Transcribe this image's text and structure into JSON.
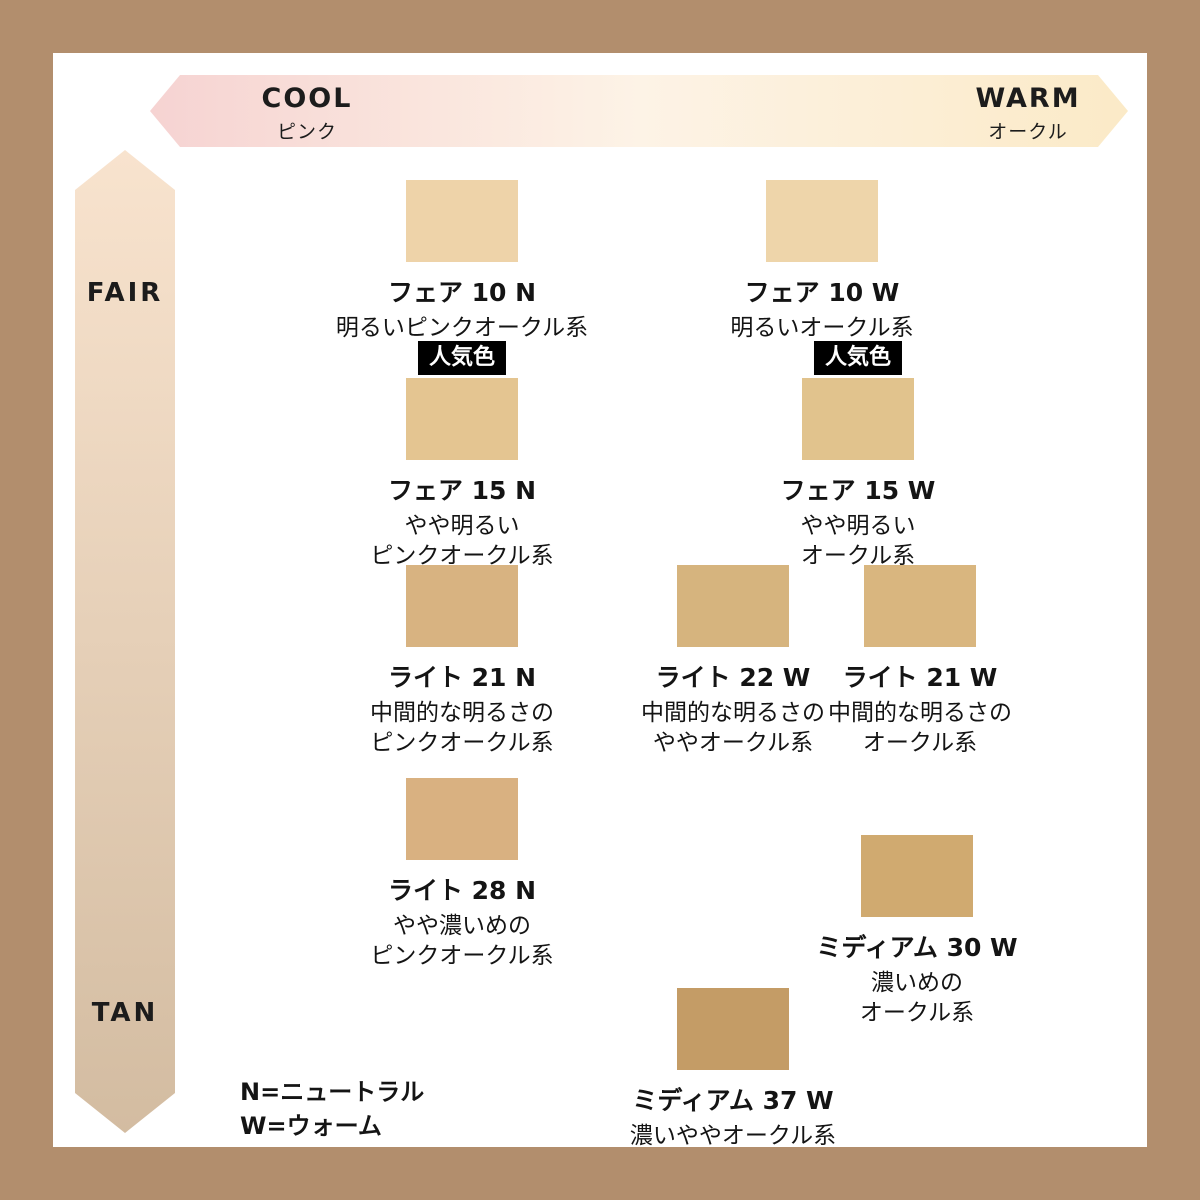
{
  "frame_color": "#b28e6d",
  "axes": {
    "horizontal": {
      "left": {
        "label": "COOL",
        "sublabel": "ピンク"
      },
      "right": {
        "label": "WARM",
        "sublabel": "オークル"
      },
      "gradient": [
        "#f6d3d2",
        "#fdf3e6",
        "#fbeac7"
      ]
    },
    "vertical": {
      "top": {
        "label": "FAIR"
      },
      "bottom": {
        "label": "TAN"
      },
      "gradient": [
        "#f8e3ce",
        "#d3bca1"
      ]
    }
  },
  "popular_badge": {
    "label": "人気色",
    "bg": "#000000",
    "text_color": "#ffffff"
  },
  "shades": [
    {
      "name": "フェア 10 N",
      "desc": "明るいピンクオークル系",
      "color": "#eed3a9",
      "popular": false
    },
    {
      "name": "フェア 10 W",
      "desc": "明るいオークル系",
      "color": "#eed5aa",
      "popular": false
    },
    {
      "name": "フェア 15 N",
      "desc": "やや明るい\nピンクオークル系",
      "color": "#e4c591",
      "popular": true
    },
    {
      "name": "フェア 15 W",
      "desc": "やや明るい\nオークル系",
      "color": "#e1c38d",
      "popular": true
    },
    {
      "name": "ライト 21 N",
      "desc": "中間的な明るさの\nピンクオークル系",
      "color": "#d8b381",
      "popular": false
    },
    {
      "name": "ライト 22 W",
      "desc": "中間的な明るさの\nややオークル系",
      "color": "#d6b47e",
      "popular": false
    },
    {
      "name": "ライト 21 W",
      "desc": "中間的な明るさの\nオークル系",
      "color": "#d9b67f",
      "popular": false
    },
    {
      "name": "ライト 28 N",
      "desc": "やや濃いめの\nピンクオークル系",
      "color": "#d9b181",
      "popular": false
    },
    {
      "name": "ミディアム 30 W",
      "desc": "濃いめの\nオークル系",
      "color": "#d0aa70",
      "popular": false
    },
    {
      "name": "ミディアム 37 W",
      "desc": "濃いややオークル系",
      "color": "#c49c66",
      "popular": false
    }
  ],
  "legend": {
    "line1": "N=ニュートラル",
    "line2": "W=ウォーム"
  }
}
